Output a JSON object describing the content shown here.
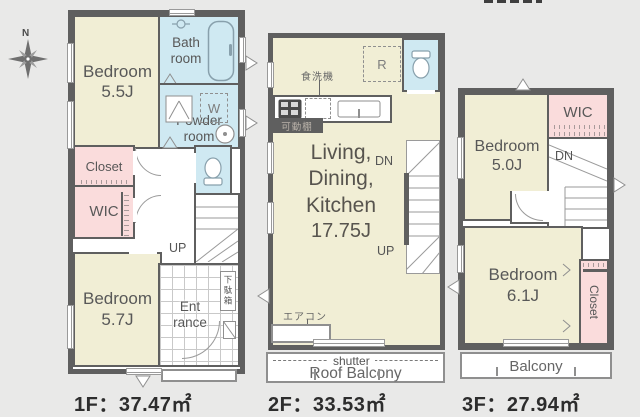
{
  "compass": {
    "north": "N"
  },
  "colors": {
    "wall": "#5f5f5f",
    "room_yellow": "#f1eed5",
    "wet_blue": "#cfe9f2",
    "storage_pink": "#fadcdc",
    "background": "#e9e9e8"
  },
  "f1": {
    "area": "1F：37.47㎡",
    "bedroom_a_name": "Bedroom",
    "bedroom_a_size": "5.5J",
    "bath_line1": "Bath",
    "bath_line2": "room",
    "powder_line1": "Powder",
    "powder_line2": "room",
    "washer": "W",
    "closet": "Closet",
    "wic": "WIC",
    "bedroom_b_name": "Bedroom",
    "bedroom_b_size": "5.7J",
    "entrance_line1": "Ent",
    "entrance_line2": "rance",
    "shoe_box": "下駄箱",
    "up": "UP"
  },
  "f2": {
    "area": "2F：33.53㎡",
    "dishwasher": "食洗機",
    "fridge": "R",
    "movable_shelf": "可動棚",
    "ldk_line1": "Living,",
    "ldk_line2": "Dining,",
    "ldk_line3": "Kitchen",
    "ldk_size": "17.75J",
    "dn": "DN",
    "up": "UP",
    "aircon": "エアコン",
    "shutter": "shutter",
    "roof_balcony": "Roof Balcony"
  },
  "f3": {
    "area": "3F：27.94㎡",
    "bedroom_a_name": "Bedroom",
    "bedroom_a_size": "5.0J",
    "wic": "WIC",
    "dn": "DN",
    "bedroom_b_name": "Bedroom",
    "bedroom_b_size": "6.1J",
    "closet": "Closet",
    "balcony": "Balcony"
  }
}
